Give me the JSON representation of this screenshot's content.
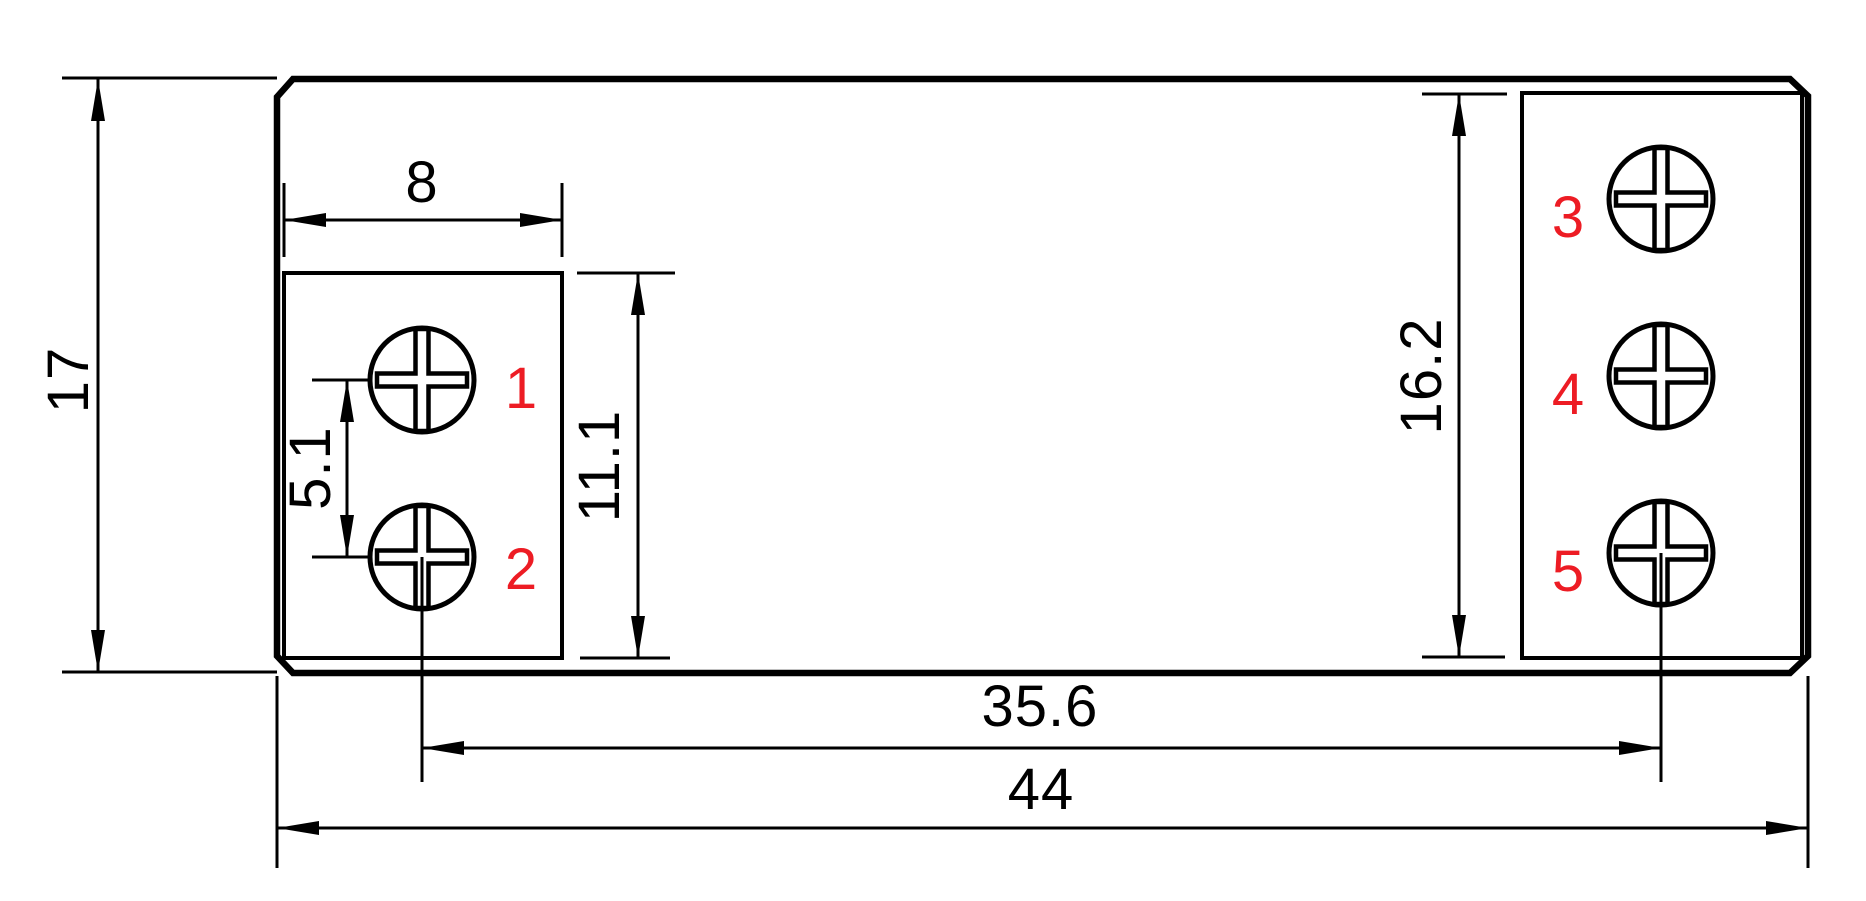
{
  "drawing": {
    "background": "#ffffff",
    "line_color": "#000000",
    "red_label_color": "#ed1c24",
    "dimensions": {
      "overall_height": "17",
      "terminal_pad_width": "8",
      "screw_pitch": "5.1",
      "left_pad_height": "11.1",
      "right_pad_height": "16.2",
      "screw2_to_screw5_span": "35.6",
      "overall_width": "44"
    },
    "terminals": [
      {
        "number": "1"
      },
      {
        "number": "2"
      },
      {
        "number": "3"
      },
      {
        "number": "4"
      },
      {
        "number": "5"
      }
    ]
  }
}
